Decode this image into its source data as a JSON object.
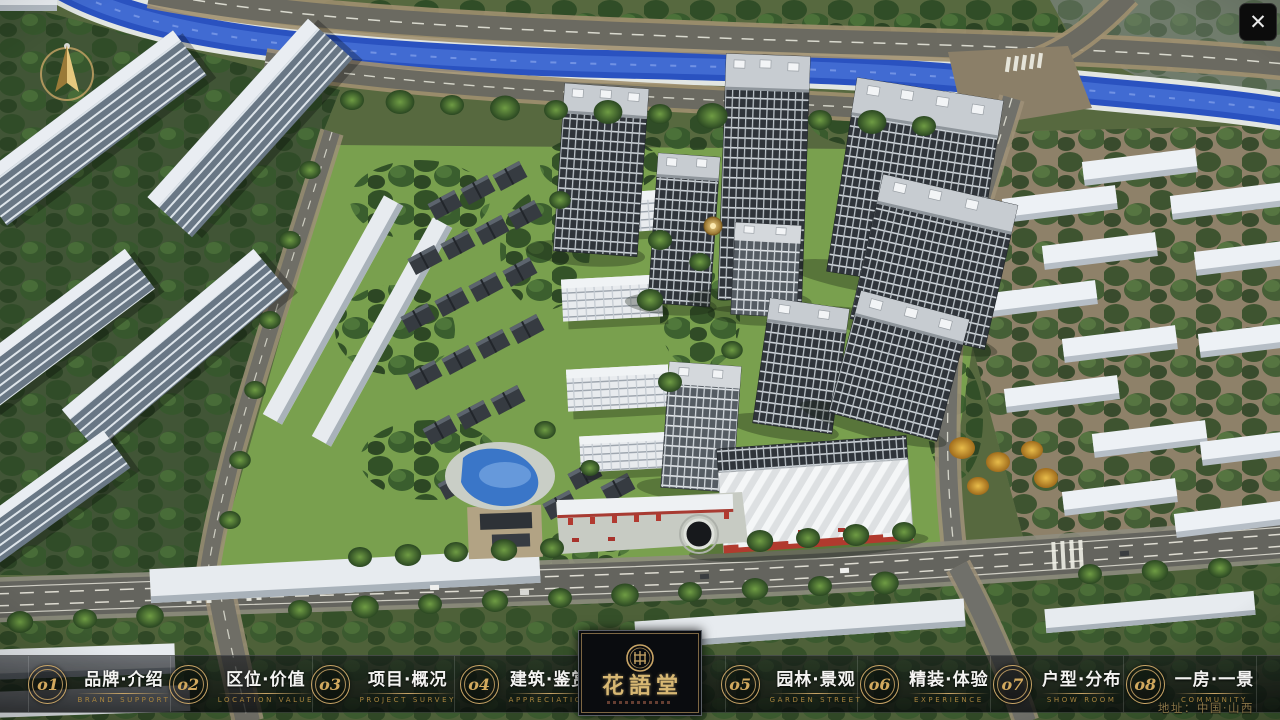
{
  "window": {
    "title": "楼盘数字沙盘 - 鸟瞰总平"
  },
  "icons": {
    "close": "✕",
    "compass": "north-arrow",
    "seal": "印章"
  },
  "nav": {
    "items": [
      {
        "num": "o1",
        "zh": "品牌·介绍",
        "en": "BRAND SUPPORT"
      },
      {
        "num": "o2",
        "zh": "区位·价值",
        "en": "LOCATION VALUE"
      },
      {
        "num": "o3",
        "zh": "项目·概况",
        "en": "PROJECT SURVEY"
      },
      {
        "num": "o4",
        "zh": "建筑·鉴赏",
        "en": "APPRECIATION"
      },
      {
        "num": "o5",
        "zh": "园林·景观",
        "en": "GARDEN STREET"
      },
      {
        "num": "o6",
        "zh": "精装·体验",
        "en": "EXPERIENCE"
      },
      {
        "num": "o7",
        "zh": "户型·分布",
        "en": "SHOW ROOM"
      },
      {
        "num": "o8",
        "zh": "一房·一景",
        "en": "COMMUNITY"
      }
    ]
  },
  "logo": {
    "name": "花語堂",
    "seal_text": "花語堂"
  },
  "footer": {
    "address": "地址：中国·山西"
  },
  "colors": {
    "gold": "#c9a566",
    "bar_bg": "rgba(8,10,13,0.65)",
    "river": "#2a52c0",
    "lawn": "#79a04e",
    "asphalt": "#6b6a61",
    "accent_red": "#b23a30"
  }
}
